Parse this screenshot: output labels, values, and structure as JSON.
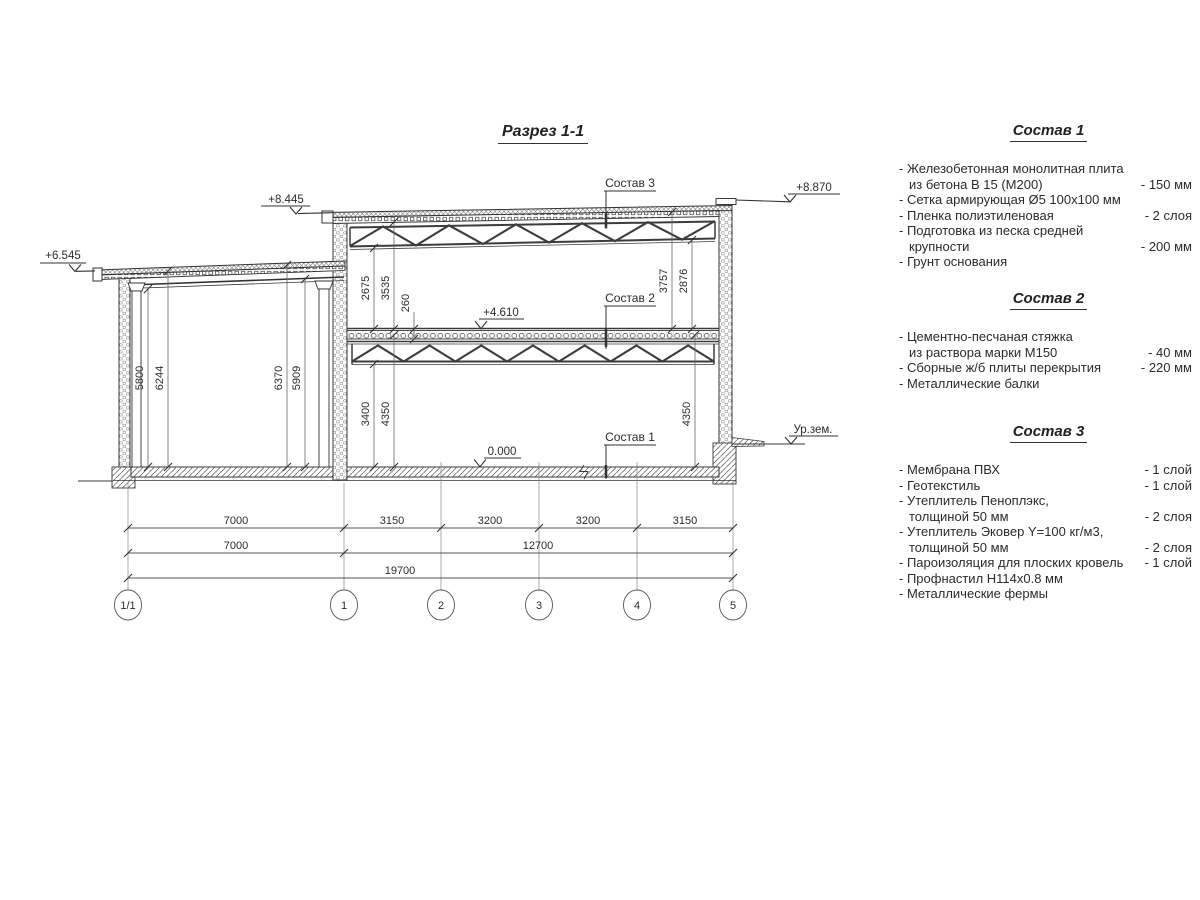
{
  "drawing": {
    "title": "Разрез 1-1",
    "leaders": {
      "s1": "Состав 1",
      "s2": "Состав 2",
      "s3": "Состав 3"
    },
    "elevations": {
      "left_roof": "+6.545",
      "upper_left": "+8.445",
      "parapet": "+8.870",
      "floor2": "+4.610",
      "floor1": "0.000",
      "ground": "Ур.зем."
    },
    "vdims": {
      "v5800": "5800",
      "v6244": "6244",
      "v6370": "6370",
      "v5909": "5909",
      "v2675": "2675",
      "v3535": "3535",
      "v260": "260",
      "v3757": "3757",
      "v2876": "2876",
      "v3400": "3400",
      "v4350l": "4350",
      "v4350r": "4350"
    },
    "hdims": {
      "row1": [
        "7000",
        "3150",
        "3200",
        "3200",
        "3150"
      ],
      "row2": [
        "7000",
        "12700"
      ],
      "row3": [
        "19700"
      ]
    },
    "grid": [
      "1/1",
      "1",
      "2",
      "3",
      "4",
      "5"
    ]
  },
  "legend": {
    "sections": [
      {
        "title": "Состав 1",
        "rows": [
          {
            "l": "- Железобетонная  монолитная плита",
            "r": ""
          },
          {
            "l": "из бетона В 15 (М200)",
            "r": "- 150 мм"
          },
          {
            "l": "- Сетка армирующая Ø5 100х100 мм",
            "r": ""
          },
          {
            "l": "- Пленка полиэтиленовая",
            "r": "-  2 слоя"
          },
          {
            "l": "- Подготовка из песка средней",
            "r": ""
          },
          {
            "l": "крупности",
            "r": "- 200 мм"
          },
          {
            "l": "- Грунт основания",
            "r": ""
          }
        ]
      },
      {
        "title": "Состав 2",
        "rows": [
          {
            "l": "- Цементно-песчаная стяжка",
            "r": ""
          },
          {
            "l": "из раствора марки М150",
            "r": "- 40 мм"
          },
          {
            "l": "- Сборные ж/б плиты перекрытия",
            "r": "- 220 мм"
          },
          {
            "l": "- Металлические балки",
            "r": ""
          }
        ]
      },
      {
        "title": "Состав 3",
        "rows": [
          {
            "l": "- Мембрана ПВХ",
            "r": "- 1 слой"
          },
          {
            "l": "- Геотекстиль",
            "r": "- 1 слой"
          },
          {
            "l": "- Утеплитель Пеноплэкс,",
            "r": ""
          },
          {
            "l": "толщиной 50 мм",
            "r": "- 2 слоя"
          },
          {
            "l": "- Утеплитель Эковер Y=100 кг/м3,",
            "r": ""
          },
          {
            "l": "толщиной 50 мм",
            "r": "- 2 слоя"
          },
          {
            "l": "- Пароизоляция для плоских кровель",
            "r": "- 1 слой"
          },
          {
            "l": "- Профнастил Н114х0.8 мм",
            "r": ""
          },
          {
            "l": "- Металлические фермы",
            "r": ""
          }
        ]
      }
    ]
  }
}
